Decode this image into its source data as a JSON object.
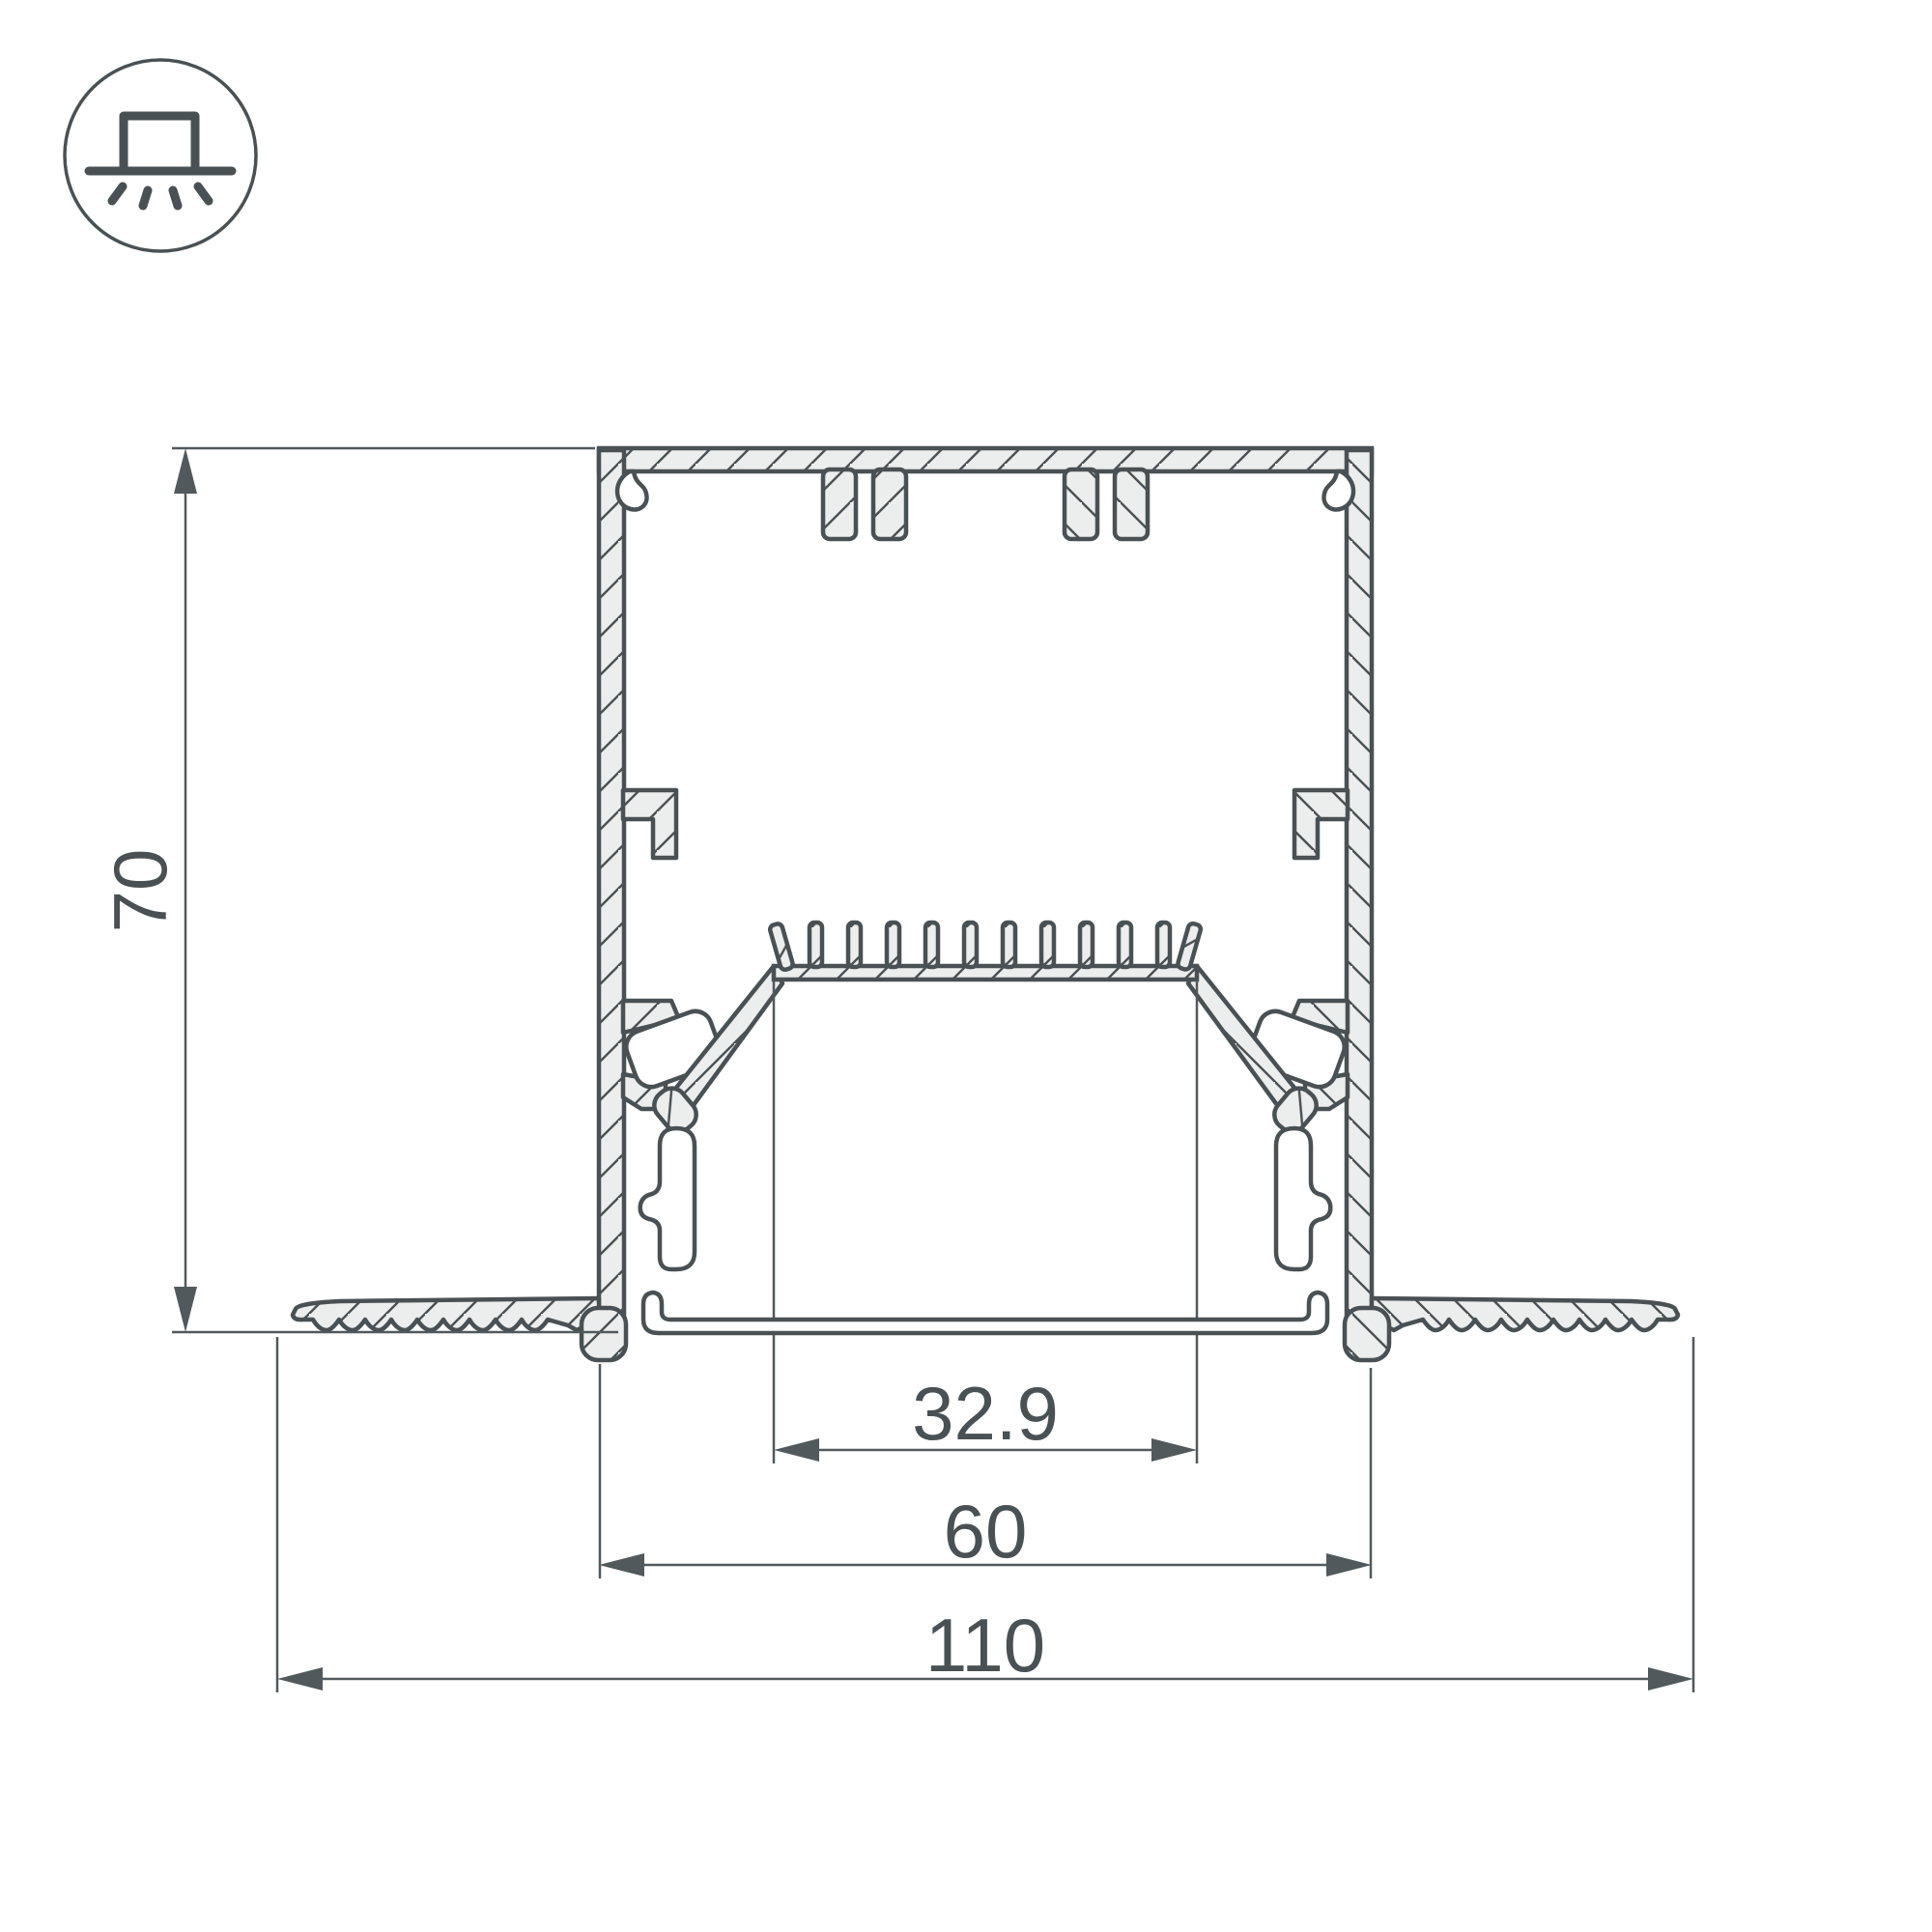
{
  "icon": {
    "name": "recessed-mount-light",
    "description": "square fixture on ceiling line with light rays shining down, inside circle"
  },
  "dimensions": {
    "height": "70",
    "opening_width": "32.9",
    "body_width": "60",
    "overall_width": "110"
  },
  "style": {
    "ink_color": "#4A5154",
    "metal_fill": "#ECEDED",
    "dimension_line_color": "#51595C",
    "background": "#FFFFFF"
  }
}
